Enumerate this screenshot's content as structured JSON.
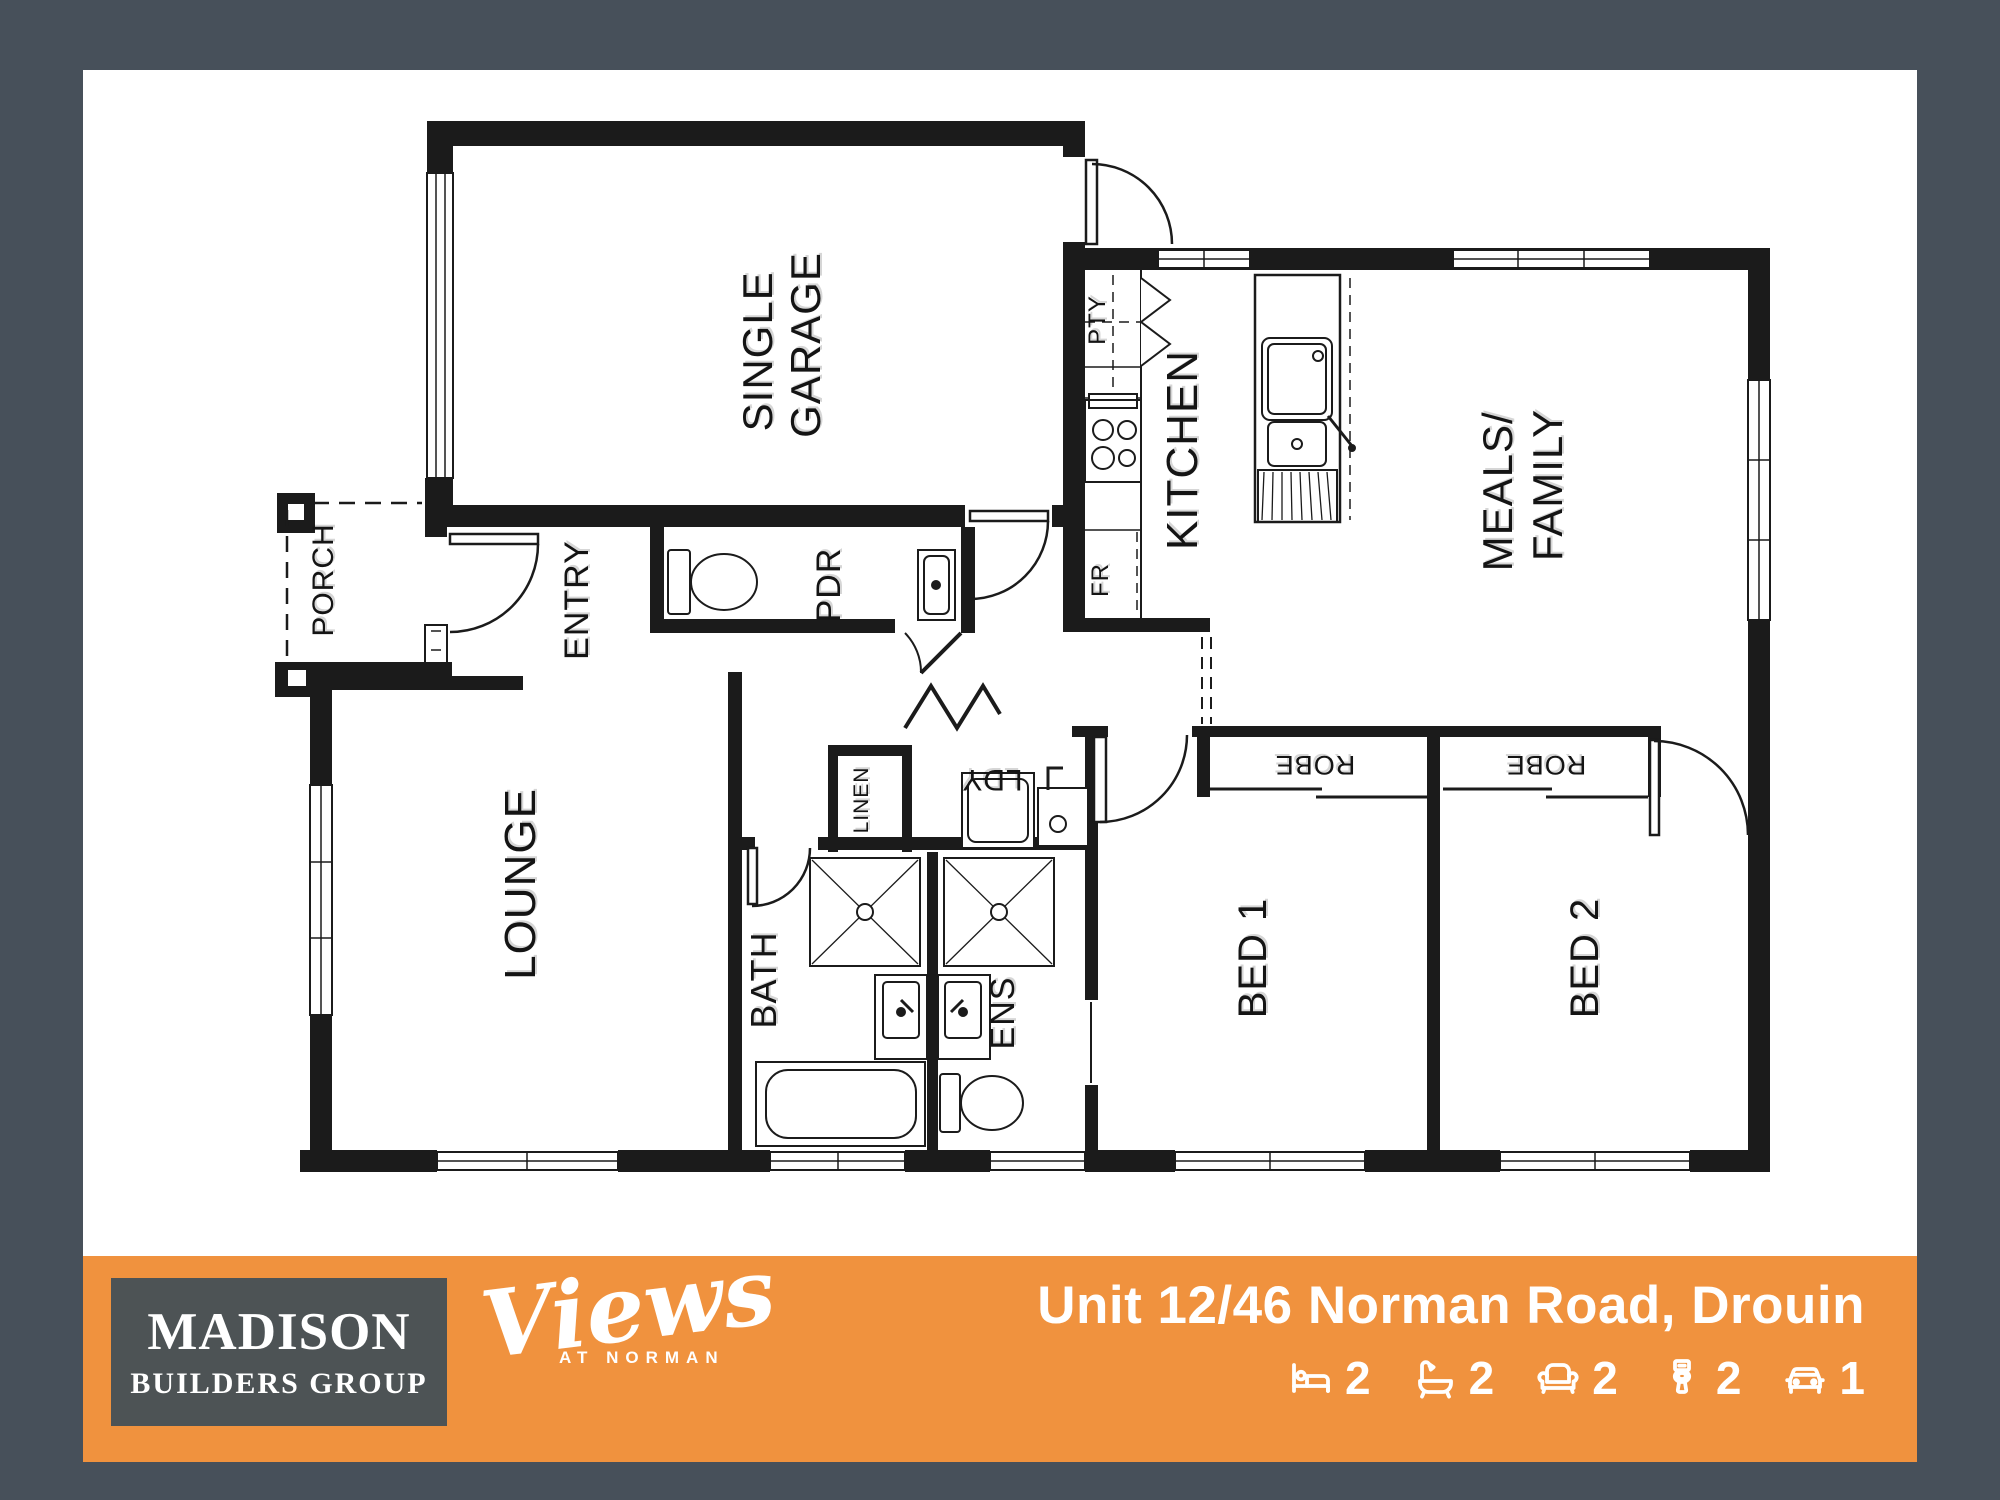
{
  "palette": {
    "frame": "#47505a",
    "canvas": "#ffffff",
    "banner_orange": "#f0923e",
    "logo_box_gray": "#4d5355",
    "wall_black": "#1b1b1b",
    "label_black": "#141414",
    "white": "#ffffff"
  },
  "plan": {
    "rooms": {
      "porch": "PORCH",
      "entry": "ENTRY",
      "garage_l1": "SINGLE",
      "garage_l2": "GARAGE",
      "pdr": "PDR",
      "pty": "PTY",
      "fr": "FR",
      "kitchen": "KITCHEN",
      "meals_l1": "MEALS/",
      "meals_l2": "FAMILY",
      "lounge": "LOUNGE",
      "linen": "LINEN",
      "ldy": "LDY",
      "robe1": "ROBE",
      "robe2": "ROBE",
      "bath": "BATH",
      "ens": "ENS",
      "bed1": "BED 1",
      "bed2": "BED 2"
    }
  },
  "banner": {
    "address": "Unit 12/46 Norman Road, Drouin",
    "builder": {
      "line1": "MADISON",
      "line2": "BUILDERS GROUP"
    },
    "estate": {
      "name": "Views",
      "tagline": "AT NORMAN"
    },
    "stats": [
      {
        "name": "bedrooms",
        "icon": "bed-icon",
        "value": "2"
      },
      {
        "name": "bathrooms",
        "icon": "bath-icon",
        "value": "2"
      },
      {
        "name": "living",
        "icon": "sofa-icon",
        "value": "2"
      },
      {
        "name": "toilets",
        "icon": "toilet-icon",
        "value": "2"
      },
      {
        "name": "cars",
        "icon": "car-icon",
        "value": "1"
      }
    ]
  }
}
